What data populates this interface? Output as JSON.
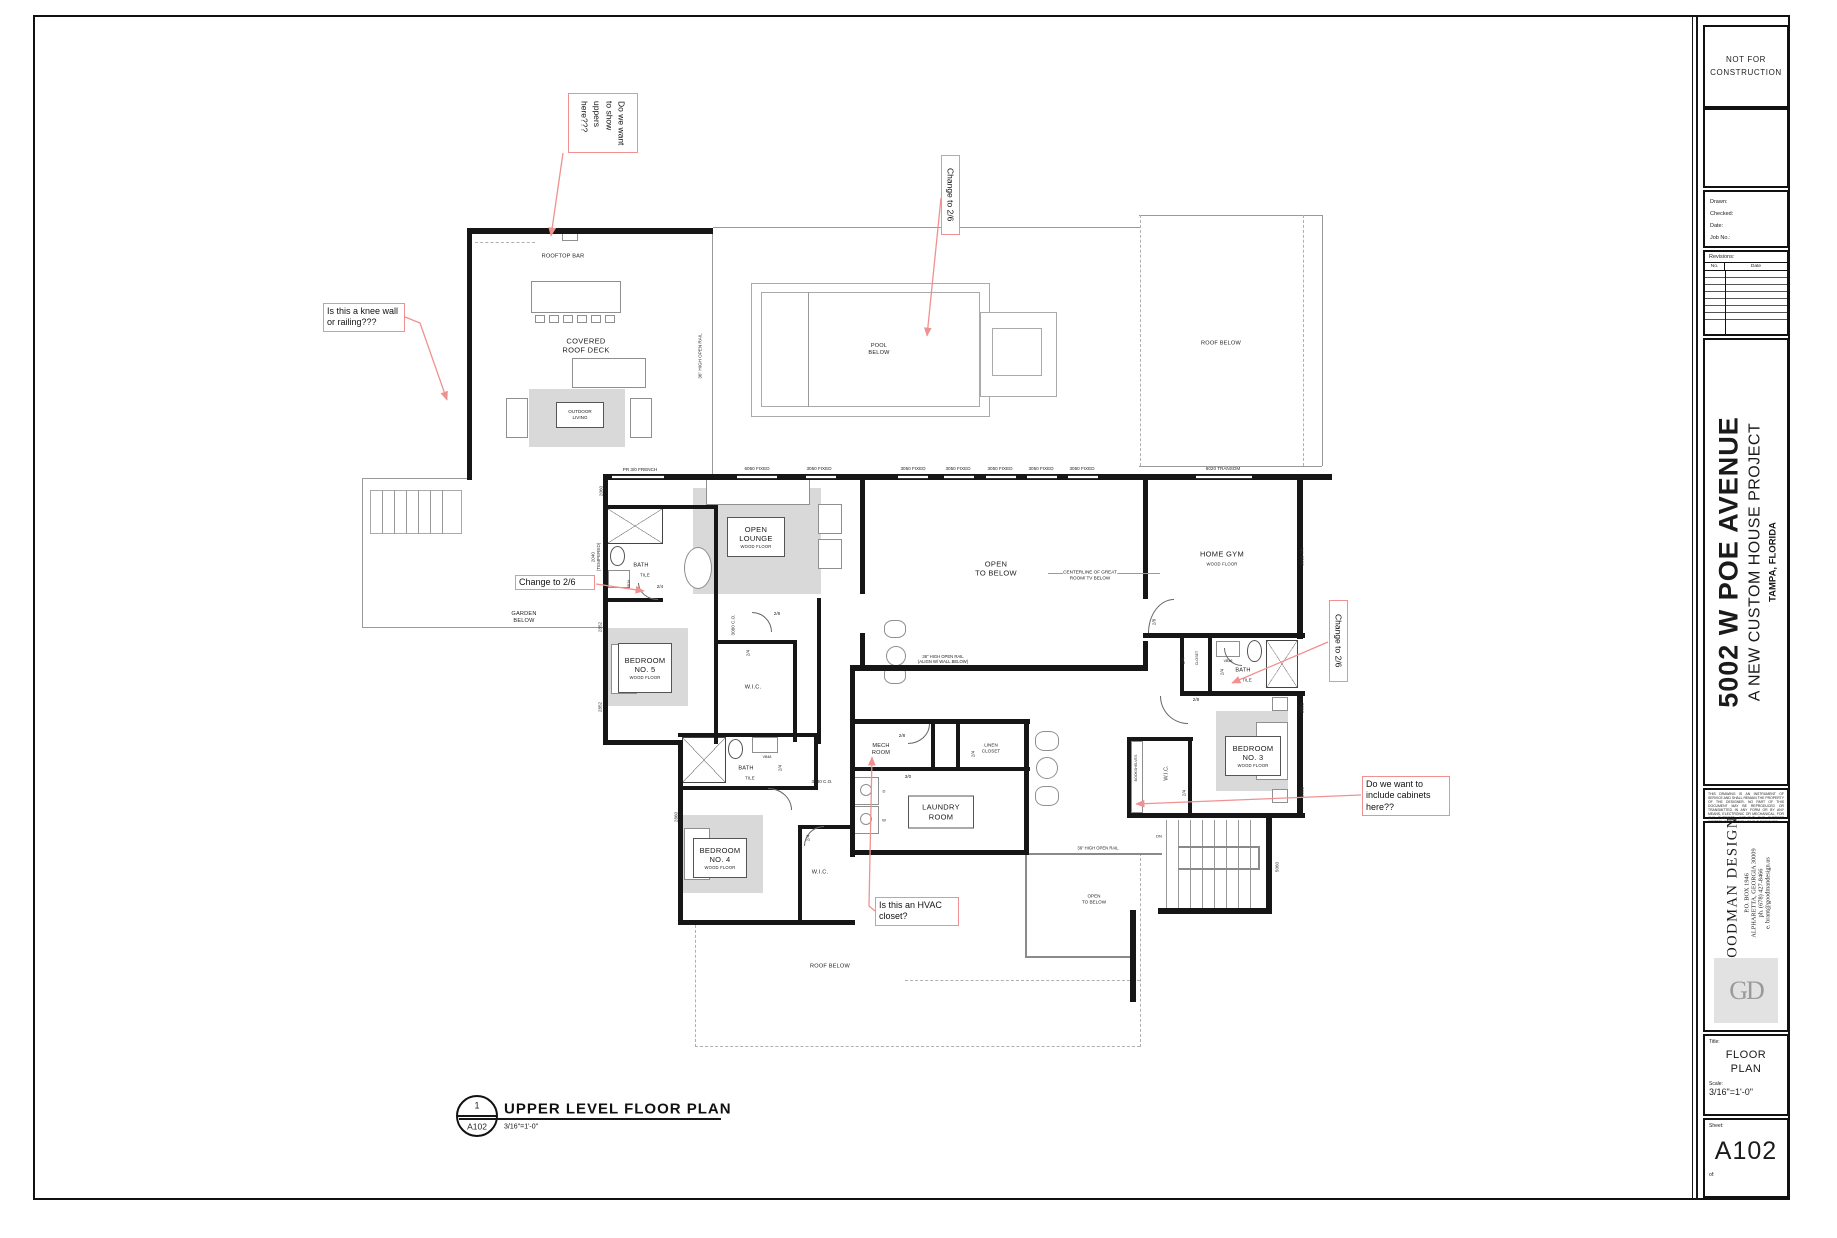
{
  "plan": {
    "rooms": {
      "rooftop_bar": "ROOFTOP BAR",
      "covered_roof_deck": "COVERED\nROOF DECK",
      "outdoor_living": "OUTDOOR\nLIVING",
      "pool_below": "POOL\nBELOW",
      "roof_below": "ROOF BELOW",
      "open_lounge": "OPEN\nLOUNGE",
      "open_to_below": "OPEN\nTO BELOW",
      "centerline_note": "CENTERLINE OF GREAT\nROOM/ TV BELOW",
      "home_gym": "HOME GYM",
      "garden_below": "GARDEN\nBELOW",
      "bath": "BATH",
      "tile": "TILE",
      "wood_floor": "WOOD FLOOR",
      "bedroom5": "BEDROOM\nNO. 5",
      "bedroom4": "BEDROOM\nNO. 4",
      "bedroom3": "BEDROOM\nNO. 3",
      "wic": "W.I.C.",
      "mech_room": "MECH\nROOM",
      "laundry_room": "LAUNDRY\nROOM",
      "linen_closet": "LINEN\nCLOSET",
      "bookshelves": "BOOKSHELVES",
      "closet": "CLOSET",
      "dn": "DN"
    },
    "windows": {
      "w6050": "6050 FIXED",
      "w3050": "3050 FIXED",
      "w6020": "6020 TRANSOM",
      "french": "PR 3/0 FRENCH"
    },
    "dims": {
      "d2060": "2060",
      "d2040": "2040\n(TEMPERED)",
      "d2852": "2852",
      "d2860": "2860",
      "d3060tr": "3060 TR",
      "d5060": "5060",
      "d3080co": "3080 C.O."
    },
    "doors": {
      "d24": "2/4",
      "d28": "2/8",
      "d30": "3/0"
    },
    "rails": {
      "open_rail": "36\" HIGH OPEN RAIL",
      "open_rail_align": "36\" HIGH OPEN RAIL\n(ALIGN W/ WALL BELOW)"
    },
    "fixtures": {
      "vb36": "VB36",
      "vb48": "VB48",
      "washer": "W",
      "dryer": "D"
    }
  },
  "annotations": {
    "uppers": "Do we want\nto show\nuppers\nhere???",
    "knee_wall": "Is this a knee wall\nor railing???",
    "change_26": "Change to 2/6",
    "cabinets": "Do we want to\ninclude cabinets\nhere??",
    "hvac": "Is this an HVAC\ncloset?"
  },
  "view_title": {
    "number": "1",
    "sheet_ref": "A102",
    "title": "UPPER LEVEL FLOOR PLAN",
    "scale": "3/16\"=1'-0\""
  },
  "title_block": {
    "stamp": "NOT FOR\nCONSTRUCTION",
    "drawn": "Drawn:",
    "checked": "Checked:",
    "date": "Date:",
    "job_no": "Job No.:",
    "revisions": "Revisions:",
    "rev_no": "No.",
    "rev_date": "Date",
    "project_address": "5002 W POE AVENUE",
    "project_subtitle": "A NEW CUSTOM HOUSE PROJECT",
    "project_city": "TAMPA, FLORIDA",
    "disclaimer": "THIS DRAWING IS AN INSTRUMENT OF SERVICE AND SHALL REMAIN THE PROPERTY OF THE DESIGNER. NO PART OF THIS DOCUMENT MAY BE REPRODUCED OR TRANSMITTED IN ANY FORM OR BY ANY MEANS, ELECTRONIC OR MECHANICAL, FOR ANY PURPOSE, WITHOUT THE EXPRESS WRITTEN PERMISSION OF THE DESIGNER.",
    "firm_name": "GOODMAN DESIGN",
    "firm_po": "P.O. BOX 1946",
    "firm_city": "ALPHARETTA, GEORGIA 30009",
    "firm_phone": "ph. (678) 427-8466",
    "firm_email": "e. brant@goodmandesign.us",
    "logo": "GD",
    "title_label": "Title:",
    "sheet_title": "FLOOR\nPLAN",
    "scale_label": "Scale:",
    "scale": "3/16\"=1'-0\"",
    "sheet_label": "Sheet:",
    "sheet_number": "A102",
    "of_label": "of:"
  }
}
